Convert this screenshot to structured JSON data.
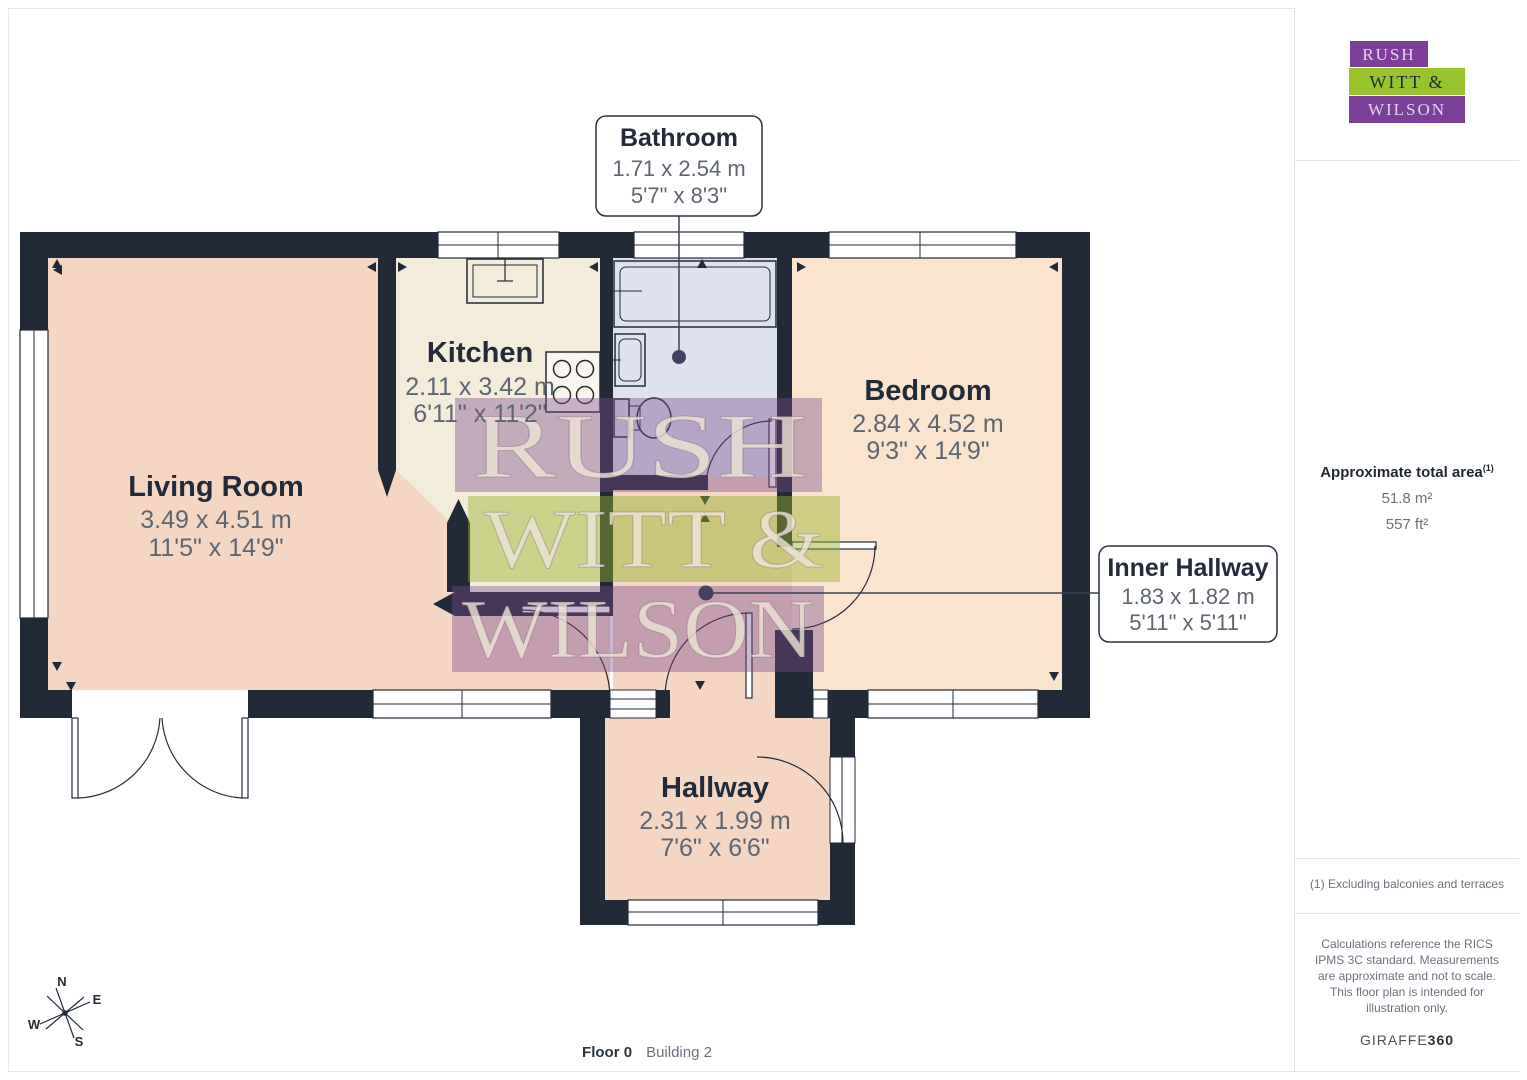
{
  "plan": {
    "rooms": [
      {
        "name": "Living Room",
        "metric": "3.49 x 4.51 m",
        "imperial": "11'5\" x 14'9\""
      },
      {
        "name": "Kitchen",
        "metric": "2.11 x 3.42 m",
        "imperial": "6'11\" x 11'2\""
      },
      {
        "name": "Bedroom",
        "metric": "2.84 x 4.52 m",
        "imperial": "9'3\" x 14'9\""
      },
      {
        "name": "Hallway",
        "metric": "2.31 x 1.99 m",
        "imperial": "7'6\" x 6'6\""
      }
    ],
    "callouts": [
      {
        "name": "Bathroom",
        "metric": "1.71 x 2.54 m",
        "imperial": "5'7\" x 8'3\""
      },
      {
        "name": "Inner Hallway",
        "metric": "1.83 x 1.82 m",
        "imperial": "5'11\" x 5'11\""
      }
    ],
    "compass": {
      "n": "N",
      "e": "E",
      "s": "S",
      "w": "W"
    },
    "watermark": {
      "line1": "RUSH",
      "line2": "WITT &",
      "line3": "WILSON"
    }
  },
  "footer": {
    "floor": "Floor 0",
    "building": "Building 2"
  },
  "sidebar": {
    "logo": {
      "line1": "RUSH",
      "line2": "WITT &",
      "line3": "WILSON"
    },
    "area": {
      "title": "Approximate total area",
      "superscript": "(1)",
      "metric": "51.8 m²",
      "imperial": "557 ft²"
    },
    "notes": {
      "exclusion": "(1) Excluding balconies and terraces",
      "disclaimer": "Calculations reference the RICS IPMS 3C standard. Measurements are approximate and not to scale. This floor plan is intended for illustration only."
    },
    "brand": {
      "name": "GIRAFFE",
      "suffix": "360"
    }
  },
  "colors": {
    "wall": "#222a38",
    "living": "#f4d6c3",
    "kitchen": "#f3ecda",
    "bathroom": "#dee2ee",
    "bedroom": "#fbe4ce",
    "accent_purple": "#7c4099",
    "accent_green": "#99c32c"
  }
}
